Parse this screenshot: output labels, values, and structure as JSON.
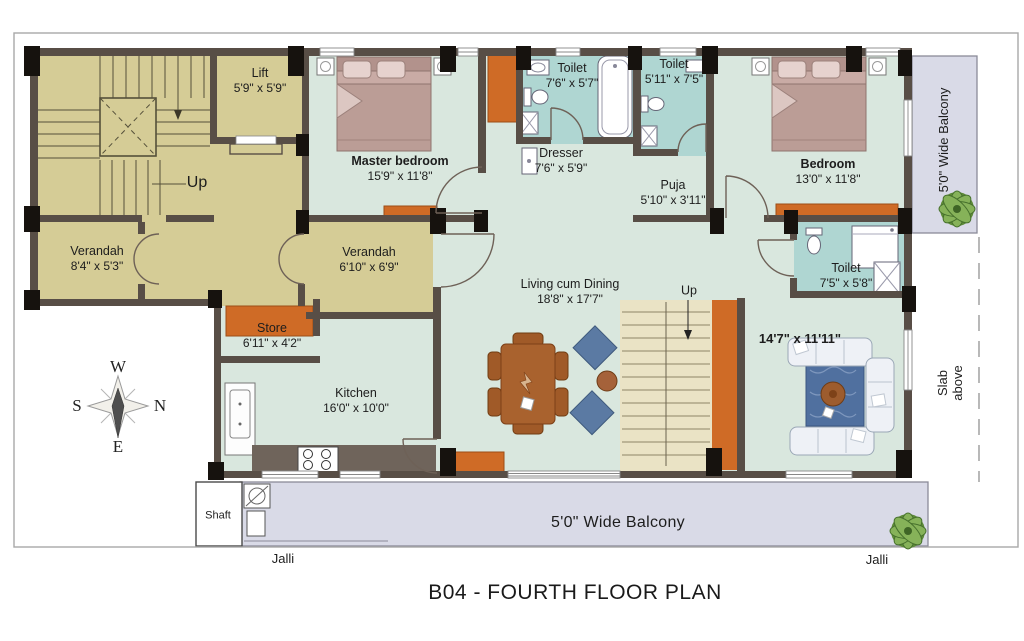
{
  "title": "B04 - FOURTH FLOOR PLAN",
  "compass": {
    "top": "W",
    "left": "S",
    "right": "N",
    "bottom": "E"
  },
  "rooms": {
    "lift": {
      "name": "Lift",
      "dims": "5'9\" x 5'9\""
    },
    "stairs_up": "Up",
    "verandah_left": {
      "name": "Verandah",
      "dims": "8'4\" x 5'3\""
    },
    "verandah_right": {
      "name": "Verandah",
      "dims": "6'10\" x 6'9\""
    },
    "master_bedroom": {
      "name": "Master bedroom",
      "dims": "15'9\" x 11'8\""
    },
    "dresser": {
      "name": "Dresser",
      "dims": "7'6\" x 5'9\""
    },
    "toilet_master": {
      "name": "Toilet",
      "dims": "7'6\" x 5'7\""
    },
    "toilet_common": {
      "name": "Toilet",
      "dims": "5'11\" x 7'5\""
    },
    "puja": {
      "name": "Puja",
      "dims": "5'10\" x 3'11\""
    },
    "bedroom": {
      "name": "Bedroom",
      "dims": "13'0\" x 11'8\""
    },
    "toilet_bedroom": {
      "name": "Toilet",
      "dims": "7'5\" x 5'8\""
    },
    "family_room": {
      "dims": "14'7\" x 11'11\""
    },
    "living_dining": {
      "name": "Living cum Dining",
      "dims": "18'8\" x 17'7\""
    },
    "inner_stairs_up": "Up",
    "store": {
      "name": "Store",
      "dims": "6'11\" x 4'2\""
    },
    "kitchen": {
      "name": "Kitchen",
      "dims": "16'0\" x 10'0\""
    },
    "shaft": "Shaft",
    "jalli_left": "Jalli",
    "jalli_right": "Jalli",
    "balcony_bottom": "5'0\" Wide Balcony",
    "balcony_right": "5'0\" Wide Balcony",
    "slab_above": "Slab above"
  },
  "colors": {
    "wall": "#584e46",
    "column": "#16120e",
    "stair_tan": "#d5cc96",
    "room_mint": "#d9e7de",
    "toilet_teal": "#afd6d2",
    "balcony_lavender": "#d9dae7",
    "cupboard_orange": "#cf6b26",
    "inner_stair_cream": "#eae3c5",
    "counter_gray": "#6f645b",
    "bed_pink": "#c9aba5",
    "sofa_white": "#eef1f6",
    "rug_blue": "#50709f",
    "table_brown": "#a9622e",
    "armchair_blue": "#5b7aa3",
    "plant_green": "#86b259"
  }
}
